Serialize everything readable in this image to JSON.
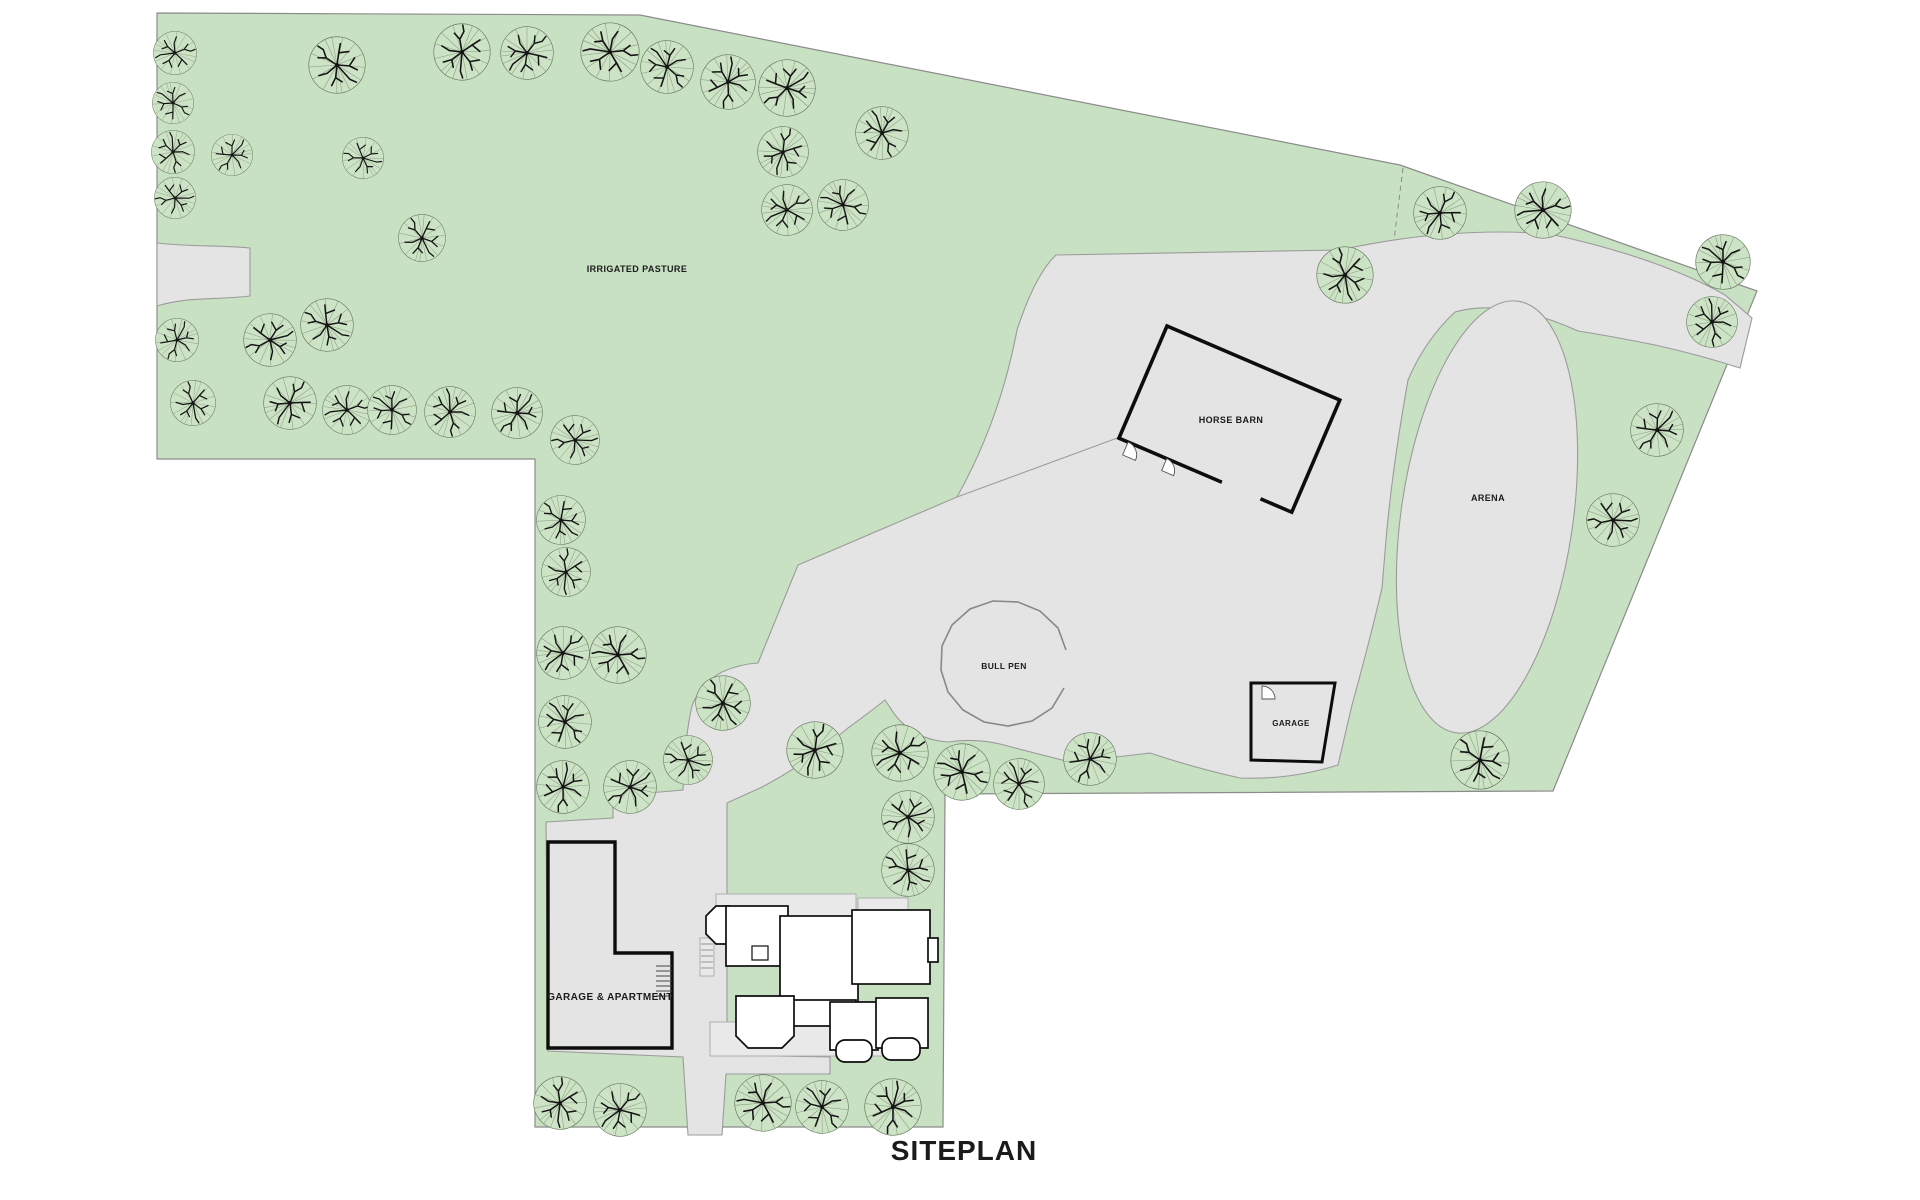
{
  "title": "SITEPLAN",
  "labels": {
    "pasture": "IRRIGATED PASTURE",
    "horse_barn": "HORSE BARN",
    "arena": "ARENA",
    "bull_pen": "BULL PEN",
    "garage": "GARAGE",
    "garage_apartment": "GARAGE & APARTMENT"
  },
  "colors": {
    "grass": "#c8e1c2",
    "paving": "#e4e4e4",
    "paving_border": "#9b9b9b",
    "porch": "#e9e9e9",
    "tree_fill": "#cde3c5",
    "tree_wedge": "#86987f",
    "tree_branch": "#141414",
    "tree_outline": "#66785f",
    "boundary": "#8b8b8b",
    "wall": "#0d0d0d",
    "label": "#1b1b1b"
  },
  "trees": [
    [
      175,
      53,
      23
    ],
    [
      173,
      103,
      22
    ],
    [
      173,
      152,
      23
    ],
    [
      232,
      155,
      22
    ],
    [
      175,
      198,
      22
    ],
    [
      337,
      65,
      30
    ],
    [
      462,
      52,
      30
    ],
    [
      527,
      53,
      28
    ],
    [
      610,
      52,
      31
    ],
    [
      667,
      67,
      28
    ],
    [
      728,
      82,
      29
    ],
    [
      787,
      88,
      30
    ],
    [
      363,
      158,
      22
    ],
    [
      422,
      238,
      25
    ],
    [
      783,
      152,
      27
    ],
    [
      787,
      210,
      27
    ],
    [
      843,
      205,
      27
    ],
    [
      882,
      133,
      28
    ],
    [
      177,
      340,
      23
    ],
    [
      270,
      340,
      28
    ],
    [
      327,
      325,
      28
    ],
    [
      193,
      403,
      24
    ],
    [
      290,
      403,
      28
    ],
    [
      347,
      410,
      26
    ],
    [
      392,
      410,
      26
    ],
    [
      450,
      412,
      27
    ],
    [
      517,
      413,
      27
    ],
    [
      575,
      440,
      26
    ],
    [
      561,
      520,
      26
    ],
    [
      566,
      572,
      26
    ],
    [
      563,
      653,
      28
    ],
    [
      618,
      655,
      30
    ],
    [
      565,
      722,
      28
    ],
    [
      563,
      787,
      28
    ],
    [
      630,
      787,
      28
    ],
    [
      688,
      760,
      26
    ],
    [
      723,
      703,
      29
    ],
    [
      815,
      750,
      30
    ],
    [
      900,
      753,
      30
    ],
    [
      962,
      772,
      30
    ],
    [
      1019,
      784,
      27
    ],
    [
      1090,
      759,
      28
    ],
    [
      908,
      817,
      28
    ],
    [
      908,
      870,
      28
    ],
    [
      1345,
      275,
      30
    ],
    [
      1440,
      213,
      28
    ],
    [
      1543,
      210,
      30
    ],
    [
      1723,
      262,
      29
    ],
    [
      1712,
      322,
      27
    ],
    [
      1657,
      430,
      28
    ],
    [
      1613,
      520,
      28
    ],
    [
      1480,
      760,
      31
    ],
    [
      560,
      1103,
      28
    ],
    [
      620,
      1110,
      28
    ],
    [
      763,
      1103,
      30
    ],
    [
      822,
      1107,
      28
    ],
    [
      893,
      1107,
      30
    ]
  ]
}
